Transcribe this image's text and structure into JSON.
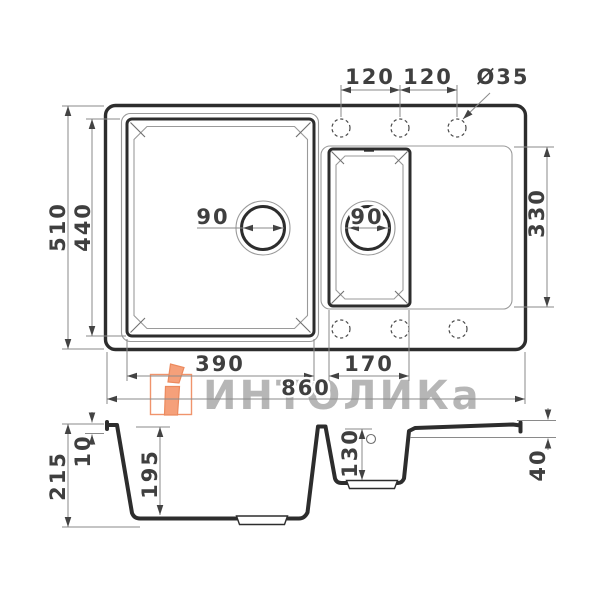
{
  "drawing": {
    "title": "sink-technical-drawing",
    "top_view": {
      "total_width": "860",
      "total_height": "510",
      "main_bowl_width": "390",
      "main_bowl_height": "440",
      "small_bowl_width": "170",
      "right_zone_height": "330",
      "faucet_spacing_left": "120",
      "faucet_spacing_right": "120",
      "faucet_hole_diameter": "Ø35",
      "main_drain_diameter": "90",
      "small_drain_diameter": "90"
    },
    "side_view": {
      "total_depth": "215",
      "rim_height": "10",
      "main_bowl_depth": "195",
      "small_bowl_depth": "130",
      "right_edge_height": "40"
    }
  },
  "watermark": {
    "brand_text": "ИНТОЛИКа",
    "logo_color": "#f5a07a",
    "text_color": "#a4a4a4"
  },
  "colors": {
    "line_thick": "#2d2d2d",
    "line_thin": "#9a9a9a",
    "dim_line": "#8a8a8a",
    "dim_text": "#3f3f3f",
    "background": "#ffffff"
  }
}
